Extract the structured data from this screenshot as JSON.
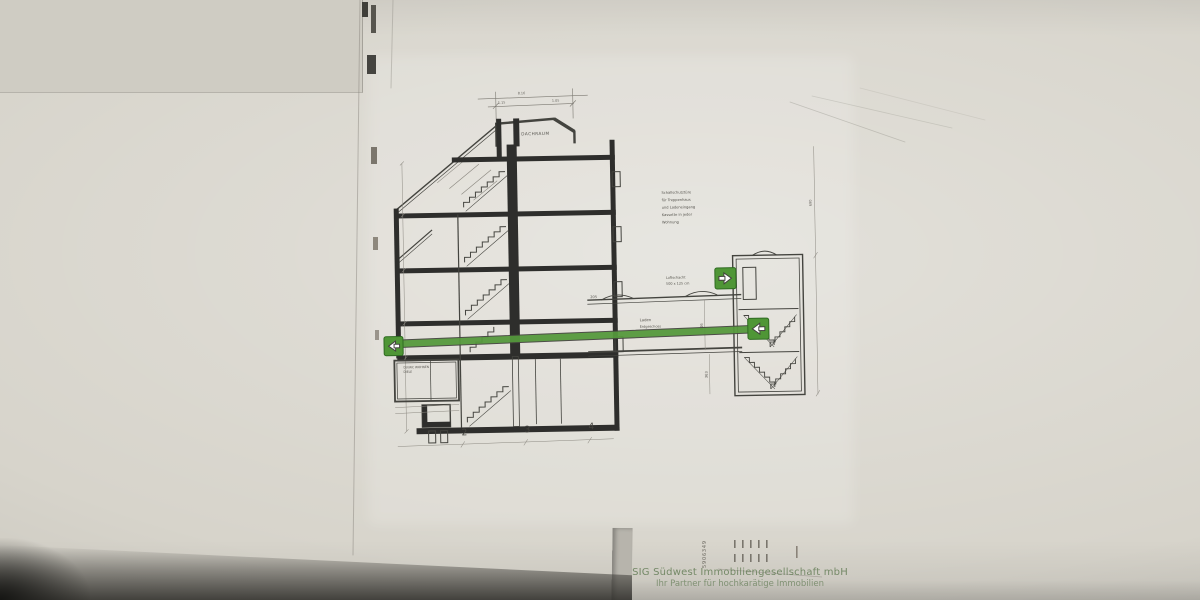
{
  "watermark": {
    "line1": "SIG Südwest Immobiliengesellschaft mbH",
    "line2": "Ihr Partner für hochkarätige Immobilien"
  },
  "drawing": {
    "attic_label": "DACHRAUM",
    "note": {
      "l1": "Schallschutztüre",
      "l2": "für Treppenhaus",
      "l3": "und Ladeneingang",
      "l4": "Kassette in jeder",
      "l5": "Wohnung"
    },
    "shaft_note": {
      "l1": "Luftschacht",
      "l2": "500 x 125 cm"
    },
    "corridor_label": {
      "l1": "Laden",
      "l2": "Erdgeschoss"
    },
    "room_label": {
      "l1": "DU/WC WOHNEN",
      "l2": "DIELE"
    },
    "dims": {
      "d205": "205",
      "d516": "516",
      "d363": "363",
      "d690": "690",
      "top1": "1.15",
      "top2": "8.16",
      "top3": "1.05"
    },
    "grid": {
      "g2": "2",
      "g3": "3",
      "g4": "4"
    },
    "stamp_number": "5906349"
  },
  "colors": {
    "route_green": "#55993c",
    "icon_green": "#4f9636",
    "icon_border": "#2f6b22",
    "watermark_green": "#68805a"
  }
}
